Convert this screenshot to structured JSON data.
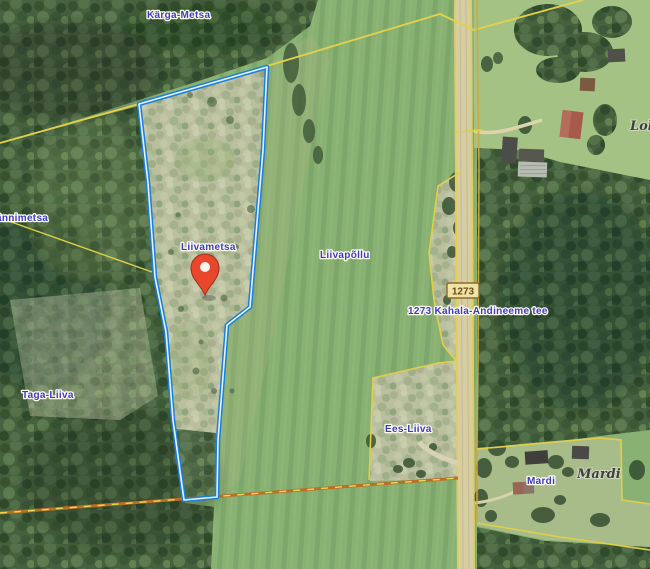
{
  "map": {
    "type": "satellite-cadastral-map",
    "labels": {
      "karga_metsa": "Kärga-Metsa",
      "annimetsa": "ännimetsa",
      "liivametsa": "Liivametsa",
      "liivapollu": "Liivapõllu",
      "taga_liiva": "Taga-Liiva",
      "ees_liiva": "Ees-Liiva",
      "mardi_place": "Mardi",
      "mardi_parcel": "Mardi",
      "lok_partial": "Lok",
      "road_number": "1273",
      "road_name": "1273 Kahala-Andineeme tee"
    },
    "marker": {
      "name": "selected-location-pin"
    },
    "highlight": {
      "name": "selected-parcel-outline"
    },
    "colors": {
      "parcel_highlight": "#1c7fd6",
      "parcel_highlight_inner": "#e8f4fd",
      "pin_fill": "#e8472b",
      "pin_border": "#9e2f1e",
      "boundary_yellow": "#e3d14c",
      "boundary_orange": "#b96f28",
      "label_blue": "#3a3ac8",
      "label_dark": "#3e3e3e",
      "badge_fill": "#f0e3a6",
      "badge_border": "#8a6b2f",
      "road_fill": "#d7cda2"
    }
  }
}
